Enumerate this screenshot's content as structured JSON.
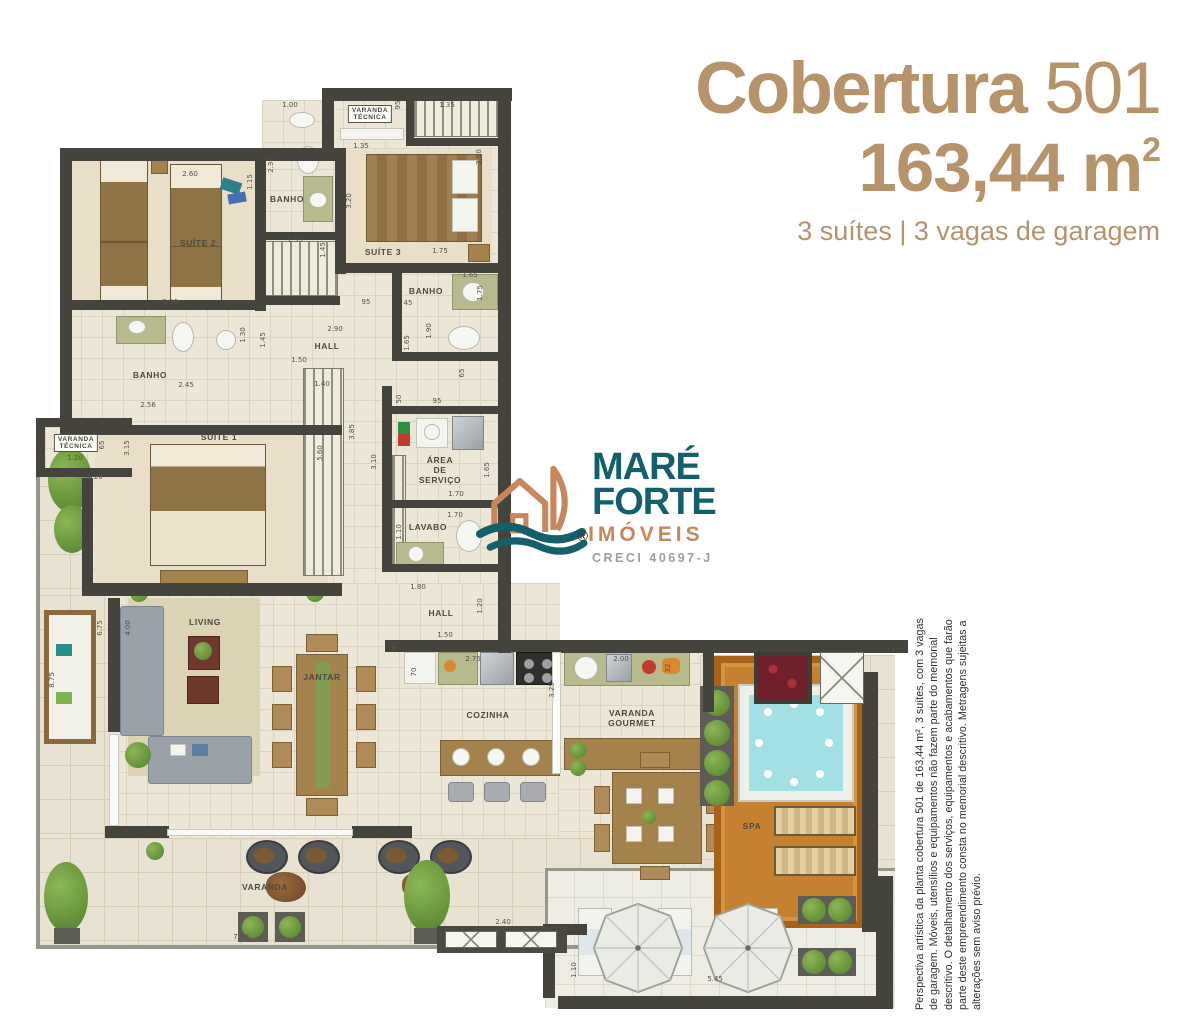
{
  "header": {
    "title_main": "Cobertura",
    "title_number": "501",
    "area_value": "163,44 m",
    "area_exponent": "2",
    "subtitle": "3 suítes | 3 vagas de garagem",
    "accent_color": "#b6936a"
  },
  "logo": {
    "name_line1": "MARÉ",
    "name_line2": "FORTE",
    "name_line3": "IMÓVEIS",
    "registered_mark": "®",
    "creci": "CRECI 40697-J",
    "teal": "#135f6b",
    "orange": "#c5875b",
    "gray": "#97a0a6"
  },
  "disclaimer": {
    "text": "Perspectiva artística da planta cobertura 501 de 163,44 m², 3 suítes, com 3 vagas de garagem. Móveis, utensílios e equipamentos não fazem parte do memorial descritivo. O detalhamento dos serviços, equipamentos e acabamentos que farão parte deste empreendimento consta no memorial descritivo. Metragens sujeitas a alterações sem aviso prévio."
  },
  "plan": {
    "room_labels": [
      {
        "id": "banho-suite-2",
        "text": "BANHO",
        "x": 287,
        "y": 199
      },
      {
        "id": "varanda-tecnica-top",
        "text": "VARANDA\nTÉCNICA",
        "x": 370,
        "y": 114,
        "boxed": true
      },
      {
        "id": "suite-2",
        "text": "SUÍTE 2",
        "x": 198,
        "y": 243
      },
      {
        "id": "suite-3",
        "text": "SUÍTE 3",
        "x": 383,
        "y": 252
      },
      {
        "id": "banho-suite-3",
        "text": "BANHO",
        "x": 426,
        "y": 291
      },
      {
        "id": "hall-upper",
        "text": "HALL",
        "x": 327,
        "y": 346
      },
      {
        "id": "banho-suite-1",
        "text": "BANHO",
        "x": 150,
        "y": 375
      },
      {
        "id": "suite-1",
        "text": "SUÍTE 1",
        "x": 219,
        "y": 437
      },
      {
        "id": "varanda-tecnica-left",
        "text": "VARANDA\nTÉCNICA",
        "x": 76,
        "y": 443,
        "boxed": true
      },
      {
        "id": "area-de-servico",
        "text": "ÁREA\nDE\nSERVIÇO",
        "x": 440,
        "y": 470
      },
      {
        "id": "lavabo",
        "text": "LAVABO",
        "x": 428,
        "y": 527
      },
      {
        "id": "hall-lower",
        "text": "HALL",
        "x": 441,
        "y": 613
      },
      {
        "id": "living",
        "text": "LIVING",
        "x": 205,
        "y": 622
      },
      {
        "id": "jantar",
        "text": "JANTAR",
        "x": 322,
        "y": 677
      },
      {
        "id": "cozinha",
        "text": "COZINHA",
        "x": 488,
        "y": 715
      },
      {
        "id": "varanda-gourmet",
        "text": "VARANDA\nGOURMET",
        "x": 632,
        "y": 718
      },
      {
        "id": "spa",
        "text": "SPA",
        "x": 752,
        "y": 826
      },
      {
        "id": "varanda",
        "text": "VARANDA",
        "x": 265,
        "y": 887
      }
    ],
    "dimensions": [
      {
        "t": "1.00",
        "x": 290,
        "y": 105
      },
      {
        "t": "95",
        "x": 398,
        "y": 105,
        "r": 1
      },
      {
        "t": "1.35",
        "x": 447,
        "y": 105
      },
      {
        "t": "2.30",
        "x": 271,
        "y": 165,
        "r": 1
      },
      {
        "t": "1.15",
        "x": 250,
        "y": 182,
        "r": 1
      },
      {
        "t": "2.60",
        "x": 190,
        "y": 174
      },
      {
        "t": "1.35",
        "x": 361,
        "y": 146
      },
      {
        "t": "3.20",
        "x": 349,
        "y": 201,
        "r": 1
      },
      {
        "t": "2.50",
        "x": 479,
        "y": 157,
        "r": 1
      },
      {
        "t": "1.75",
        "x": 440,
        "y": 251
      },
      {
        "t": "3.96",
        "x": 170,
        "y": 302
      },
      {
        "t": "1.35",
        "x": 295,
        "y": 240
      },
      {
        "t": "1.45",
        "x": 323,
        "y": 250,
        "r": 1
      },
      {
        "t": "45",
        "x": 408,
        "y": 303
      },
      {
        "t": "1.65",
        "x": 470,
        "y": 275
      },
      {
        "t": "1.75",
        "x": 480,
        "y": 293,
        "r": 1
      },
      {
        "t": "1.90",
        "x": 429,
        "y": 331,
        "r": 1
      },
      {
        "t": "95",
        "x": 366,
        "y": 302
      },
      {
        "t": "2.90",
        "x": 335,
        "y": 329
      },
      {
        "t": "1.30",
        "x": 243,
        "y": 335,
        "r": 1
      },
      {
        "t": "1.45",
        "x": 263,
        "y": 340,
        "r": 1
      },
      {
        "t": "2.45",
        "x": 186,
        "y": 385
      },
      {
        "t": "2.56",
        "x": 148,
        "y": 405
      },
      {
        "t": "1.50",
        "x": 299,
        "y": 360
      },
      {
        "t": "1.40",
        "x": 322,
        "y": 384
      },
      {
        "t": "3.15",
        "x": 127,
        "y": 448,
        "r": 1
      },
      {
        "t": "5.60",
        "x": 320,
        "y": 453,
        "r": 1
      },
      {
        "t": "3.85",
        "x": 352,
        "y": 432,
        "r": 1
      },
      {
        "t": "1.65",
        "x": 407,
        "y": 343,
        "r": 1
      },
      {
        "t": "65",
        "x": 462,
        "y": 373,
        "r": 1
      },
      {
        "t": "50",
        "x": 399,
        "y": 399,
        "r": 1
      },
      {
        "t": "95",
        "x": 437,
        "y": 401
      },
      {
        "t": "3.10",
        "x": 374,
        "y": 462,
        "r": 1
      },
      {
        "t": "1.65",
        "x": 487,
        "y": 470,
        "r": 1
      },
      {
        "t": "1.70",
        "x": 456,
        "y": 494
      },
      {
        "t": "1.70",
        "x": 455,
        "y": 515
      },
      {
        "t": "1.10",
        "x": 399,
        "y": 532,
        "r": 1
      },
      {
        "t": "1.80",
        "x": 418,
        "y": 587
      },
      {
        "t": "1.20",
        "x": 480,
        "y": 606,
        "r": 1
      },
      {
        "t": "1.50",
        "x": 445,
        "y": 635
      },
      {
        "t": "85",
        "x": 395,
        "y": 646,
        "r": 1
      },
      {
        "t": "70",
        "x": 414,
        "y": 672,
        "r": 1
      },
      {
        "t": "2.75",
        "x": 473,
        "y": 659
      },
      {
        "t": "2.00",
        "x": 621,
        "y": 659
      },
      {
        "t": "3.25",
        "x": 552,
        "y": 690,
        "r": 1
      },
      {
        "t": "32",
        "x": 668,
        "y": 668,
        "r": 1
      },
      {
        "t": "65",
        "x": 102,
        "y": 445,
        "r": 1
      },
      {
        "t": "1.20",
        "x": 75,
        "y": 458
      },
      {
        "t": "1.20",
        "x": 95,
        "y": 477
      },
      {
        "t": "8.75",
        "x": 52,
        "y": 680,
        "r": 1
      },
      {
        "t": "6.75",
        "x": 100,
        "y": 628,
        "r": 1
      },
      {
        "t": "4.00",
        "x": 128,
        "y": 628,
        "r": 1
      },
      {
        "t": "8.40",
        "x": 328,
        "y": 849
      },
      {
        "t": "7.20",
        "x": 241,
        "y": 937
      },
      {
        "t": "2.40",
        "x": 503,
        "y": 922
      },
      {
        "t": "1.10",
        "x": 574,
        "y": 970,
        "r": 1
      },
      {
        "t": "5.45",
        "x": 715,
        "y": 979
      }
    ]
  }
}
